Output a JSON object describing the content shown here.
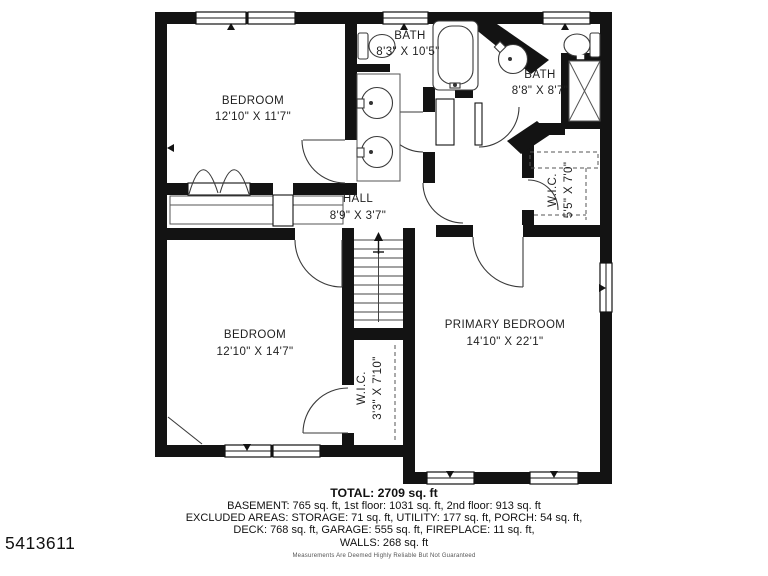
{
  "plan_id": "5413611",
  "rooms": [
    {
      "id": "bedroom-1",
      "label": "BEDROOM",
      "dims": "12'10\" X 11'7\""
    },
    {
      "id": "bath-1",
      "label": "BATH",
      "dims": "8'3\" X 10'5\""
    },
    {
      "id": "bath-2",
      "label": "BATH",
      "dims": "8'8\" X 8'7\""
    },
    {
      "id": "wic-1",
      "label": "W.I.C.",
      "dims": "5'5\" X 7'0\""
    },
    {
      "id": "hall",
      "label": "HALL",
      "dims": "8'9\" X 3'7\""
    },
    {
      "id": "bedroom-2",
      "label": "BEDROOM",
      "dims": "12'10\" X 14'7\""
    },
    {
      "id": "wic-2",
      "label": "W.I.C.",
      "dims": "3'3\" X 7'10\""
    },
    {
      "id": "primary-bedroom",
      "label": "PRIMARY BEDROOM",
      "dims": "14'10\" X 22'1\""
    }
  ],
  "summary": {
    "total": "TOTAL: 2709 sq. ft",
    "floors": "BASEMENT: 765 sq. ft, 1st floor: 1031 sq. ft, 2nd floor: 913 sq. ft",
    "excluded1": "EXCLUDED AREAS: STORAGE: 71 sq. ft, UTILITY: 177 sq. ft, PORCH: 54 sq. ft,",
    "excluded2": "DECK: 768 sq. ft, GARAGE: 555 sq. ft, FIREPLACE: 11 sq. ft,",
    "walls": "WALLS: 268 sq. ft",
    "disclaimer": "Measurements Are Deemed Highly Reliable But Not Guaranteed"
  },
  "colors": {
    "wall": "#131313",
    "floor": "#ffffff",
    "line": "#2b2b2b",
    "text": "#1f1f1f"
  }
}
